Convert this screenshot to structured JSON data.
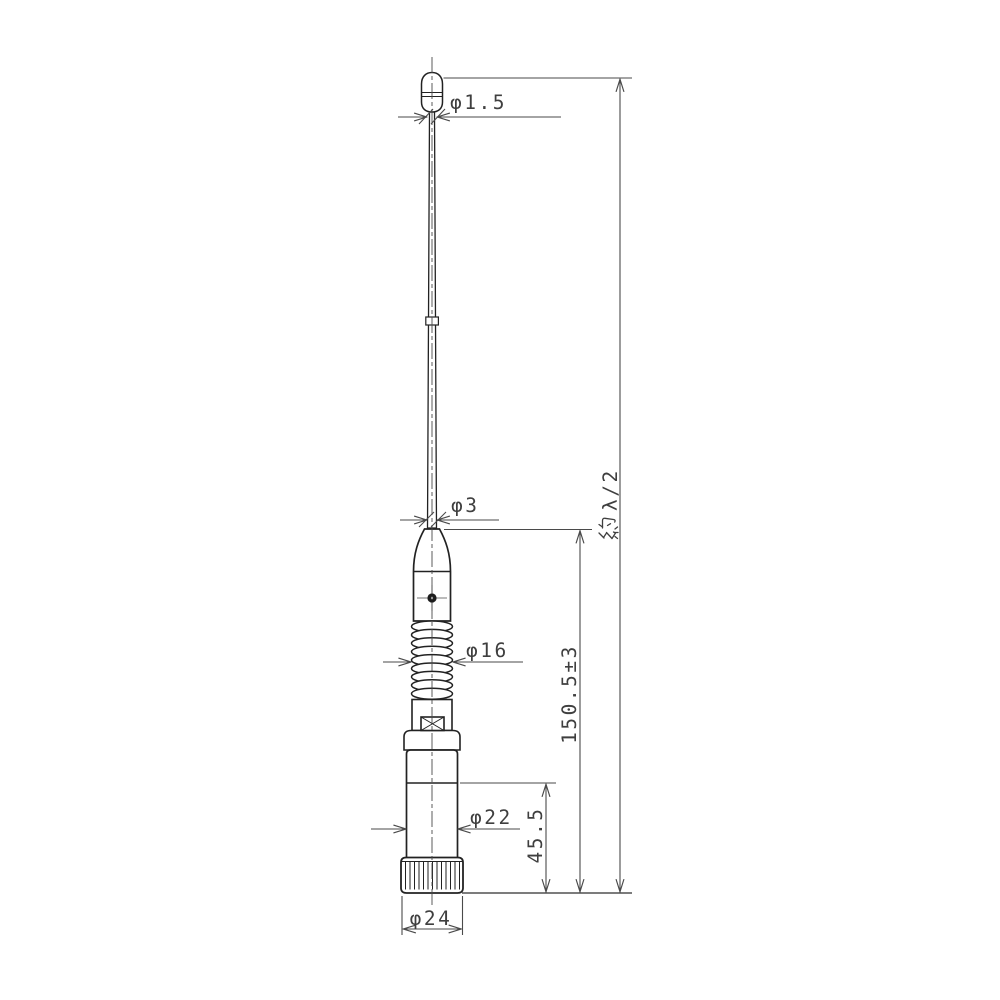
{
  "meta": {
    "background_color": "#ffffff",
    "outline_color": "#222222",
    "dimension_color": "#4a4a4a",
    "text_color": "#3f3f3f"
  },
  "dimensions": {
    "tip_diameter": "φ1.5",
    "whip_diameter": "φ3",
    "coil_diameter": "φ16",
    "body_diameter": "φ22",
    "base_diameter": "φ24",
    "lower_section_height": "45.5",
    "assembly_height": "150.5±3",
    "overall_length_prefix": "約",
    "overall_length_value": "λ/2"
  }
}
